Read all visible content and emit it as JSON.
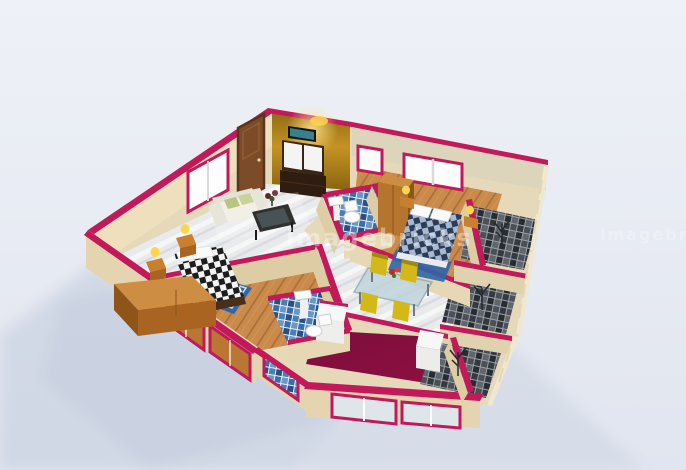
{
  "scene": {
    "type": "3d-isometric-floor-plan-render",
    "watermark": {
      "text": "imagebricks"
    },
    "rooms": [
      {
        "name": "living-room",
        "floor": "marble"
      },
      {
        "name": "master-bedroom",
        "floor": "wood"
      },
      {
        "name": "second-bedroom",
        "floor": "wood"
      },
      {
        "name": "dining-hall",
        "floor": "marble"
      },
      {
        "name": "kitchen-utility",
        "floor": "maroon-tile"
      },
      {
        "name": "bathroom-top",
        "floor": "blue-mosaic"
      },
      {
        "name": "bathroom-bottom",
        "floor": "blue-mosaic"
      },
      {
        "name": "balcony-top",
        "floor": "slate-mosaic"
      },
      {
        "name": "balcony-middle",
        "floor": "slate-mosaic"
      },
      {
        "name": "balcony-bottom",
        "floor": "slate-mosaic"
      }
    ],
    "colors": {
      "background_top": "#eef1f7",
      "background_bottom": "#e1e5ef",
      "ground_shadow": "#c3ccdc",
      "wall_top": "#c2195b",
      "wall_face": "#eee0bd",
      "wall_face_dark": "#ddcca4",
      "wall_exterior": "#e4d4af",
      "wall_ne_face": "#dcd5bb",
      "accent_wall_gold": "#c49324",
      "door_wood": "#7c4b27",
      "floor_wood": "#c98a4b",
      "floor_marble": "#e9eaec",
      "floor_kitchen": "#8e1043",
      "tile_blue": "#3a6ea9",
      "tile_slate": "#4a5056",
      "sofa_white": "#f1efe6",
      "cushion_green": "#b8c47f",
      "furniture_wood": "#b5752f",
      "chair_yellow": "#d4b818",
      "rug_blue": "#2e66a8",
      "lamp_glow": "#ffd54a",
      "glass": "#dfe6ea",
      "railing": "#efe7d0"
    }
  }
}
